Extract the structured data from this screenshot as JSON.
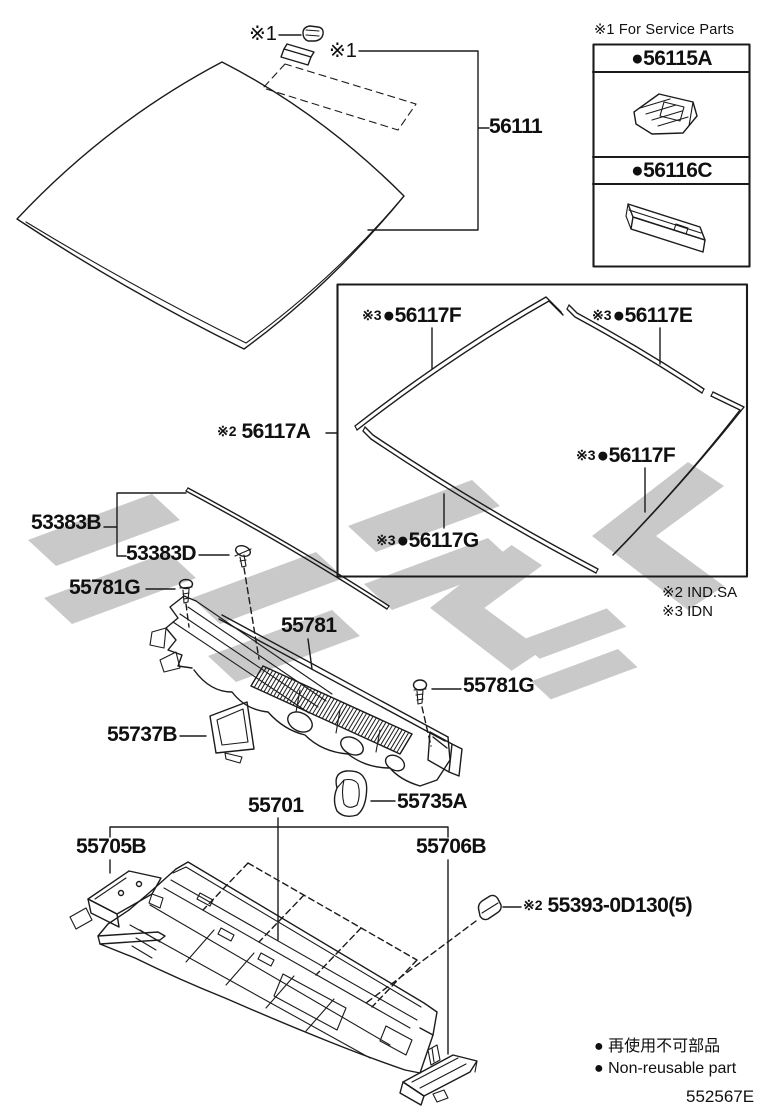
{
  "doc": {
    "code": "552567E"
  },
  "windshield": {
    "label": "56111",
    "clip_note": "※1",
    "cover_note": "※1"
  },
  "service_box": {
    "header": "※1 For Service Parts",
    "item1_label": "●56115A",
    "item2_label": "●56116C"
  },
  "molding_box": {
    "main": {
      "prefix": "※2",
      "number": "56117A"
    },
    "top_left": {
      "prefix": "※3",
      "number": "●56117F"
    },
    "top_right": {
      "prefix": "※3",
      "number": "●56117E"
    },
    "bottom_right": {
      "prefix": "※3",
      "number": "●56117F"
    },
    "bottom_left": {
      "prefix": "※3",
      "number": "●56117G"
    }
  },
  "notes": {
    "note2": "※2 IND.SA",
    "note3": "※3 IDN"
  },
  "cowl": {
    "seal": "53383B",
    "seal_clip": "53383D",
    "screw_left": "55781G",
    "panel": "55781",
    "screw_right": "55781G",
    "bracket_left": "55737B",
    "duct": "55735A"
  },
  "dash": {
    "panel": "55701",
    "bracket_left": "55705B",
    "bracket_right": "55706B",
    "clip": {
      "prefix": "※2",
      "number": "55393-0D130(5)"
    }
  },
  "legend": {
    "jp": "● 再使用不可部品",
    "en": "● Non-reusable part"
  }
}
